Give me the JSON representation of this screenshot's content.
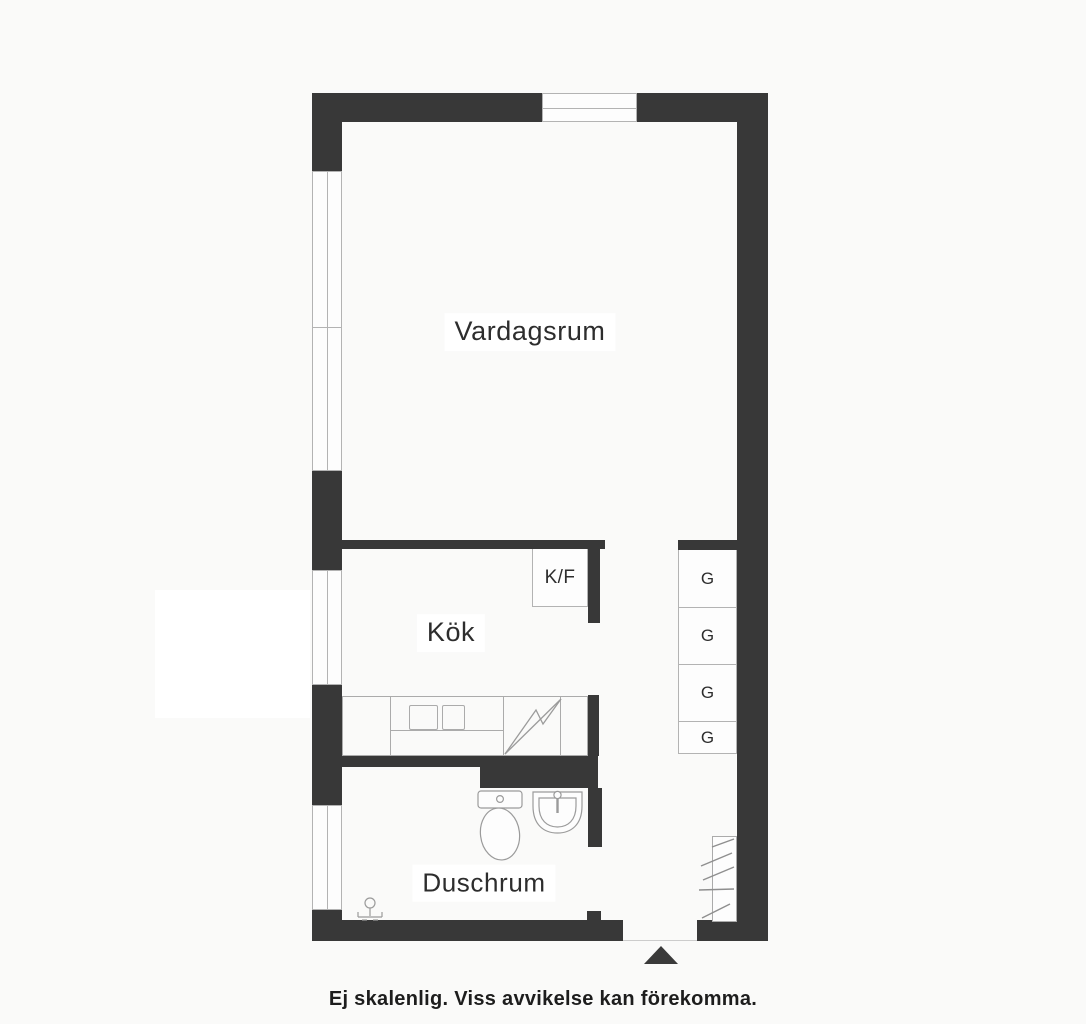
{
  "rooms": {
    "living_room": "Vardagsrum",
    "kitchen": "Kök",
    "shower_room": "Duschrum"
  },
  "fixtures": {
    "fridge_freezer_label": "K/F",
    "wardrobes": [
      "G",
      "G",
      "G",
      "G"
    ]
  },
  "footer": {
    "disclaimer": "Ej skalenlig. Viss avvikelse kan förekomma."
  },
  "icons": {
    "toilet": "toilet-icon",
    "sink": "sink-icon",
    "shower_drain": "shower-drain-icon",
    "dishwasher_zigzag": "dishwasher-zigzag-icon",
    "vent_hatch": "vent-hatch-icon",
    "entrance_arrow": "entrance-arrow-icon"
  },
  "colors": {
    "wall": "#383838",
    "window_line": "#b3b3b3",
    "fixture_line": "#9b9b9b",
    "label_text": "#2d2d2d",
    "background": "#fafaf9"
  }
}
